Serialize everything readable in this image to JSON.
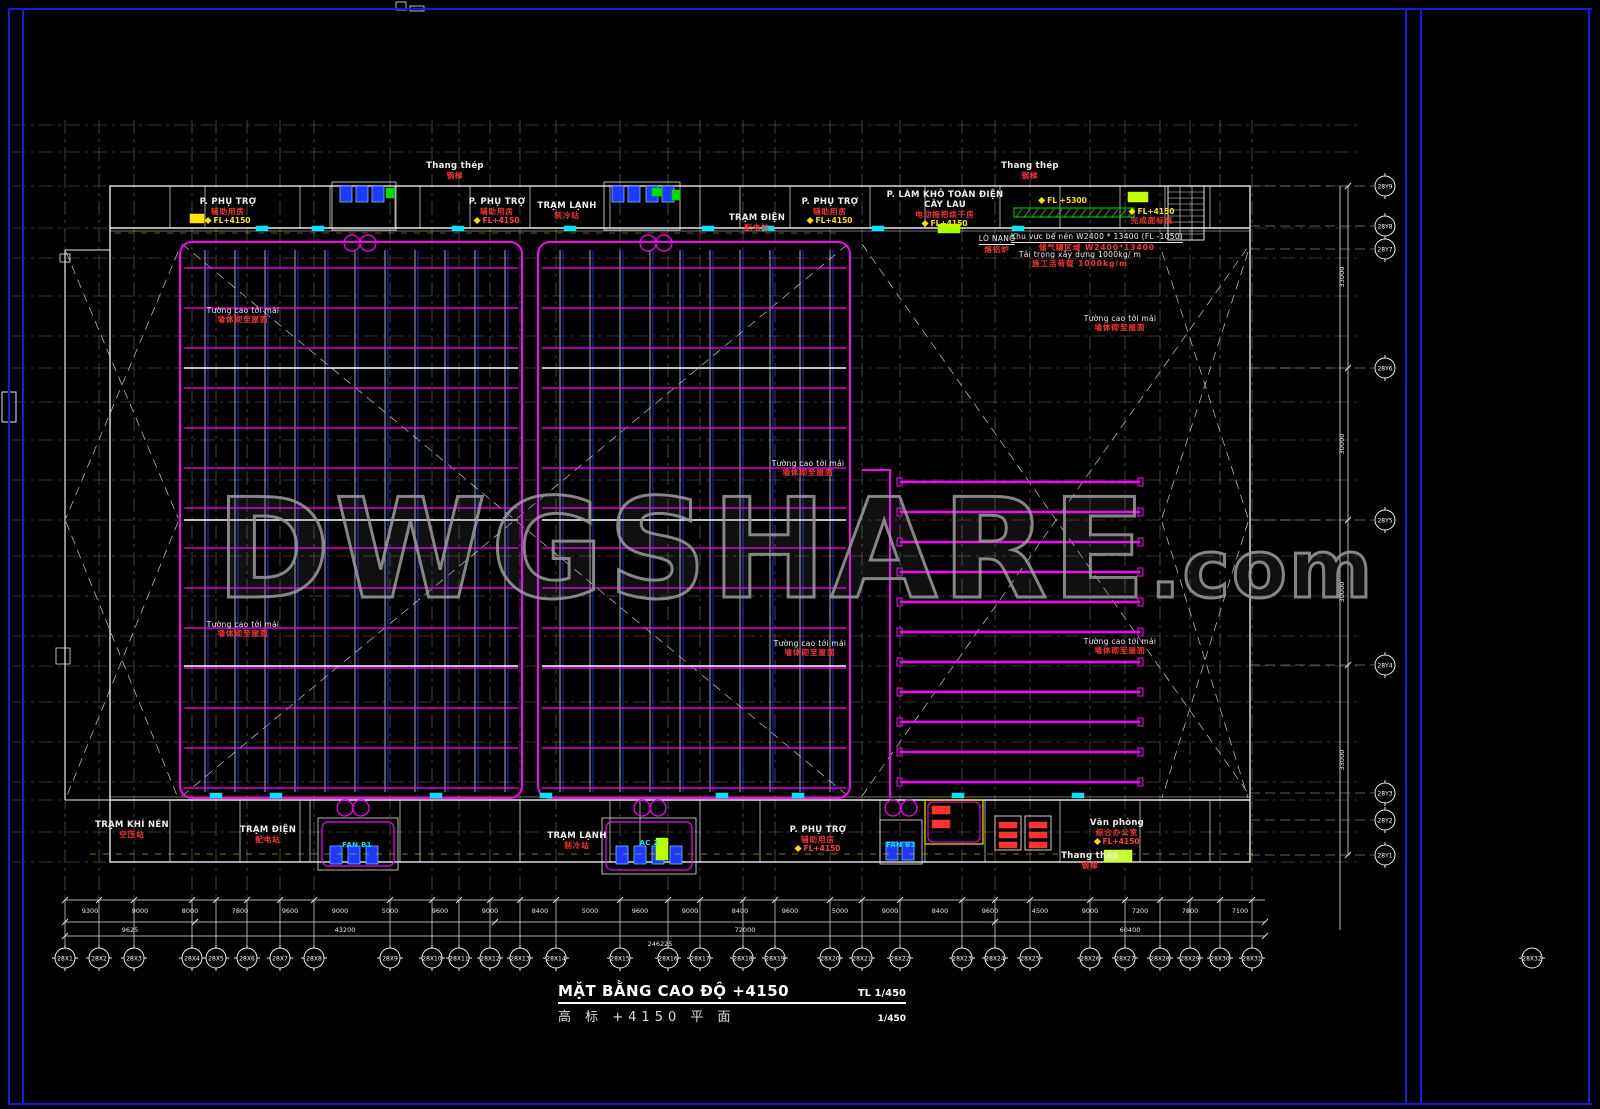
{
  "colors": {
    "magenta": "#ff00ff",
    "frame_blue": "#1a1ae6",
    "grid_gray": "#8a8a8a",
    "wall_white": "#e8e8e8",
    "cad_blue": "#2038ff",
    "cyan": "#00e5ff",
    "yellow": "#ffe000",
    "red": "#ff3232",
    "green": "#00dd00",
    "watermark_gray": "#969696"
  },
  "watermark": {
    "main": "DWGSHARE",
    "suffix": ".com"
  },
  "title_block": {
    "title_vi": "MẶT BẰNG CAO ĐỘ +4150",
    "scale_label": "TL 1/450",
    "title_cn": "高 标 +4150 平 面",
    "scale_value": "1/450"
  },
  "axes_x": {
    "labels": [
      "28X1",
      "28X2",
      "28X3",
      "28X4",
      "28X5",
      "28X6",
      "28X7",
      "28X8",
      "28X9",
      "28X10",
      "28X11",
      "28X12",
      "28X13",
      "28X14",
      "28X15",
      "28X16",
      "28X17",
      "28X18",
      "28X19",
      "28X20",
      "28X21",
      "28X22",
      "28X23",
      "28X24",
      "28X25",
      "28X26",
      "28X27",
      "28X28",
      "28X29",
      "28X30",
      "28X31"
    ],
    "far_label": "28X32"
  },
  "axes_y": {
    "labels": [
      "28Y9",
      "28Y8",
      "28Y7",
      "28Y6",
      "28Y5",
      "28Y4",
      "28Y3",
      "28Y2",
      "28Y1"
    ]
  },
  "dimensions": {
    "row1": [
      "9300",
      "9000",
      "8000",
      "7800",
      "9600",
      "9000",
      "5000",
      "9600",
      "9000",
      "8400",
      "5000",
      "9600",
      "9000",
      "8400",
      "9600",
      "5000",
      "9000",
      "8400",
      "9600",
      "4500",
      "9000",
      "7200",
      "7800",
      "7100"
    ],
    "row2": [
      "9625",
      "43200",
      "72000",
      "60400"
    ],
    "total": "246225",
    "right": [
      "33000",
      "30000",
      "30000",
      "33000"
    ]
  },
  "labels": [
    {
      "id": "room-phu-tro-top-1",
      "type": "room",
      "text": "P. PHỤ TRỢ",
      "cn": "辅助用房",
      "fl": "FL+4150",
      "flc": "#ffe000",
      "x": 228,
      "y": 197
    },
    {
      "id": "ladder-top-1",
      "type": "room",
      "text": "Thang thép",
      "cn": "钢梯",
      "x": 455,
      "y": 161
    },
    {
      "id": "room-phu-tro-top-2",
      "type": "room",
      "text": "P. PHỤ TRỢ",
      "cn": "辅助用房",
      "fl": "FL+4150",
      "flc": "#ff4040",
      "x": 497,
      "y": 197
    },
    {
      "id": "room-tram-lanh-top",
      "type": "room",
      "text": "TRẠM LẠNH",
      "cn": "制冷站",
      "x": 567,
      "y": 201
    },
    {
      "id": "room-tram-dien-top",
      "type": "room",
      "text": "TRẠM ĐIỆN",
      "cn": "配电站",
      "x": 757,
      "y": 213
    },
    {
      "id": "room-phu-tro-top-3",
      "type": "room",
      "text": "P. PHỤ TRỢ",
      "cn": "辅助用房",
      "fl": "FL+4150",
      "flc": "#ffe000",
      "x": 830,
      "y": 197
    },
    {
      "id": "room-lam-kho",
      "type": "room",
      "text": "P. LÀM KHÔ TOÀN ĐIỆN",
      "text2": "CÂY LAU",
      "cn": "电动拖把烘干房",
      "fl": "FL+4150",
      "flc": "#ffe000",
      "x": 945,
      "y": 190
    },
    {
      "id": "ladder-top-2",
      "type": "room",
      "text": "Thang thép",
      "cn": "钢梯",
      "x": 1030,
      "y": 161
    },
    {
      "id": "fl-5300",
      "type": "flag",
      "fl": "FL +5300",
      "flc": "#ffe000",
      "x": 1063,
      "y": 196
    },
    {
      "id": "fl-4150-ne",
      "type": "flag",
      "fl": "FL+4150",
      "flc": "#ffe000",
      "cn": "完成面标高",
      "x": 1152,
      "y": 207
    },
    {
      "id": "note-lo-nang",
      "type": "note",
      "text": "LÒ NẠNG",
      "cn": "熔铝炉",
      "ul": true,
      "x": 997,
      "y": 234
    },
    {
      "id": "note-khu-vuc",
      "type": "note",
      "text": "Khu vực bể nén W2400 * 13400 (FL -1050)",
      "cn": "储气罐区域 W2400*13400",
      "ul": true,
      "x": 1097,
      "y": 232
    },
    {
      "id": "note-tai-trong",
      "type": "note",
      "text": "Tải trọng xây dựng 1000kg/ m",
      "cn": "施工活荷载 1000kg/m",
      "x": 1080,
      "y": 250
    },
    {
      "id": "wall-note-1",
      "type": "wall",
      "text": "Tường cao tới mái",
      "cn": "墙体砌至屋面",
      "x": 243,
      "y": 306
    },
    {
      "id": "wall-note-2",
      "type": "wall",
      "text": "Tường cao tới mái",
      "cn": "墙体砌至屋面",
      "x": 243,
      "y": 620
    },
    {
      "id": "wall-note-3",
      "type": "wall",
      "text": "Tường cao tới mái",
      "cn": "墙体砌至屋面",
      "x": 808,
      "y": 459
    },
    {
      "id": "wall-note-4",
      "type": "wall",
      "text": "Tường cao tới mái",
      "cn": "墙体砌至屋面",
      "x": 810,
      "y": 639
    },
    {
      "id": "wall-note-5",
      "type": "wall",
      "text": "Tường cao tới mái",
      "cn": "墙体砌至屋面",
      "x": 1120,
      "y": 314
    },
    {
      "id": "wall-note-6",
      "type": "wall",
      "text": "Tường cao tới mái",
      "cn": "墙体砌至屋面",
      "x": 1120,
      "y": 637
    },
    {
      "id": "room-tram-khi-nen",
      "type": "room",
      "text": "TRẠM KHÍ NÉN",
      "cn": "空压站",
      "x": 132,
      "y": 820
    },
    {
      "id": "room-tram-dien-bot",
      "type": "room",
      "text": "TRẠM ĐIỆN",
      "cn": "配电站",
      "x": 268,
      "y": 825
    },
    {
      "id": "room-tram-lanh-bot",
      "type": "room",
      "text": "TRẠM LẠNH",
      "cn": "制冷站",
      "x": 577,
      "y": 831
    },
    {
      "id": "room-phu-tro-bot",
      "type": "room",
      "text": "P. PHỤ TRỢ",
      "cn": "辅助用房",
      "fl": "FL+4150",
      "flc": "#ff4040",
      "x": 818,
      "y": 825
    },
    {
      "id": "room-van-phong",
      "type": "room",
      "text": "Văn phòng",
      "cn": "综合办公室",
      "fl": "FL+4150",
      "flc": "#ff4040",
      "x": 1117,
      "y": 818
    },
    {
      "id": "ladder-bot",
      "type": "room",
      "text": "Thang thép",
      "cn": "钢梯",
      "x": 1090,
      "y": 851
    },
    {
      "id": "equip-fan-b1",
      "type": "equip",
      "text": "FAN B1",
      "x": 357,
      "y": 841
    },
    {
      "id": "equip-ac-2",
      "type": "equip",
      "text": "AC 2",
      "x": 649,
      "y": 839
    },
    {
      "id": "equip-fan-b3",
      "type": "equip",
      "text": "FAN B3",
      "x": 901,
      "y": 841
    }
  ]
}
